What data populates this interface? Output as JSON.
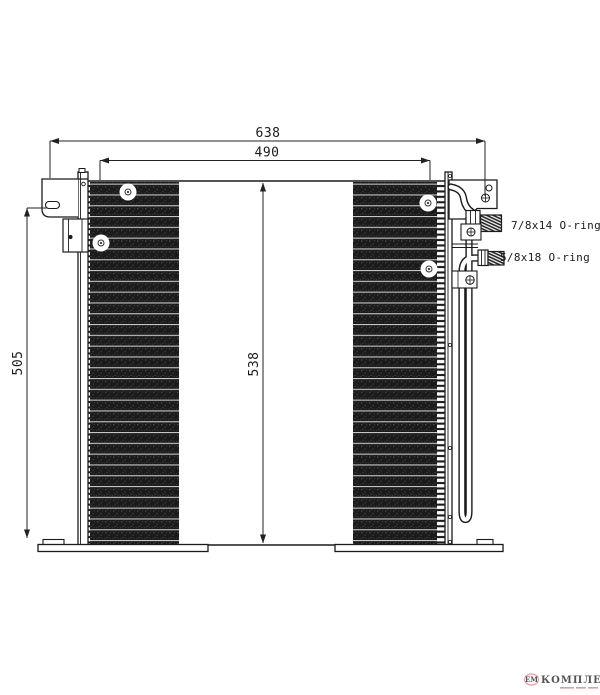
{
  "diagram": {
    "kind": "technical line drawing - air conditioning condenser, front view",
    "dims": {
      "total_width": "638",
      "core_width": "490",
      "left_height": "505",
      "core_height": "538"
    },
    "fittings": {
      "top": "7/8x14 O-ring",
      "bottom": "5/8x18 O-ring"
    },
    "colors": {
      "line": "#1b1b1b",
      "fin_dark": "#1b1b1b",
      "tube_line": "#c9c9c9"
    }
  },
  "watermark": {
    "logo_text": "ЕМ",
    "brand_text": "КОМПЛЕКТ",
    "logo_color": "#d5838a",
    "brand_color": "#aab1c7"
  }
}
